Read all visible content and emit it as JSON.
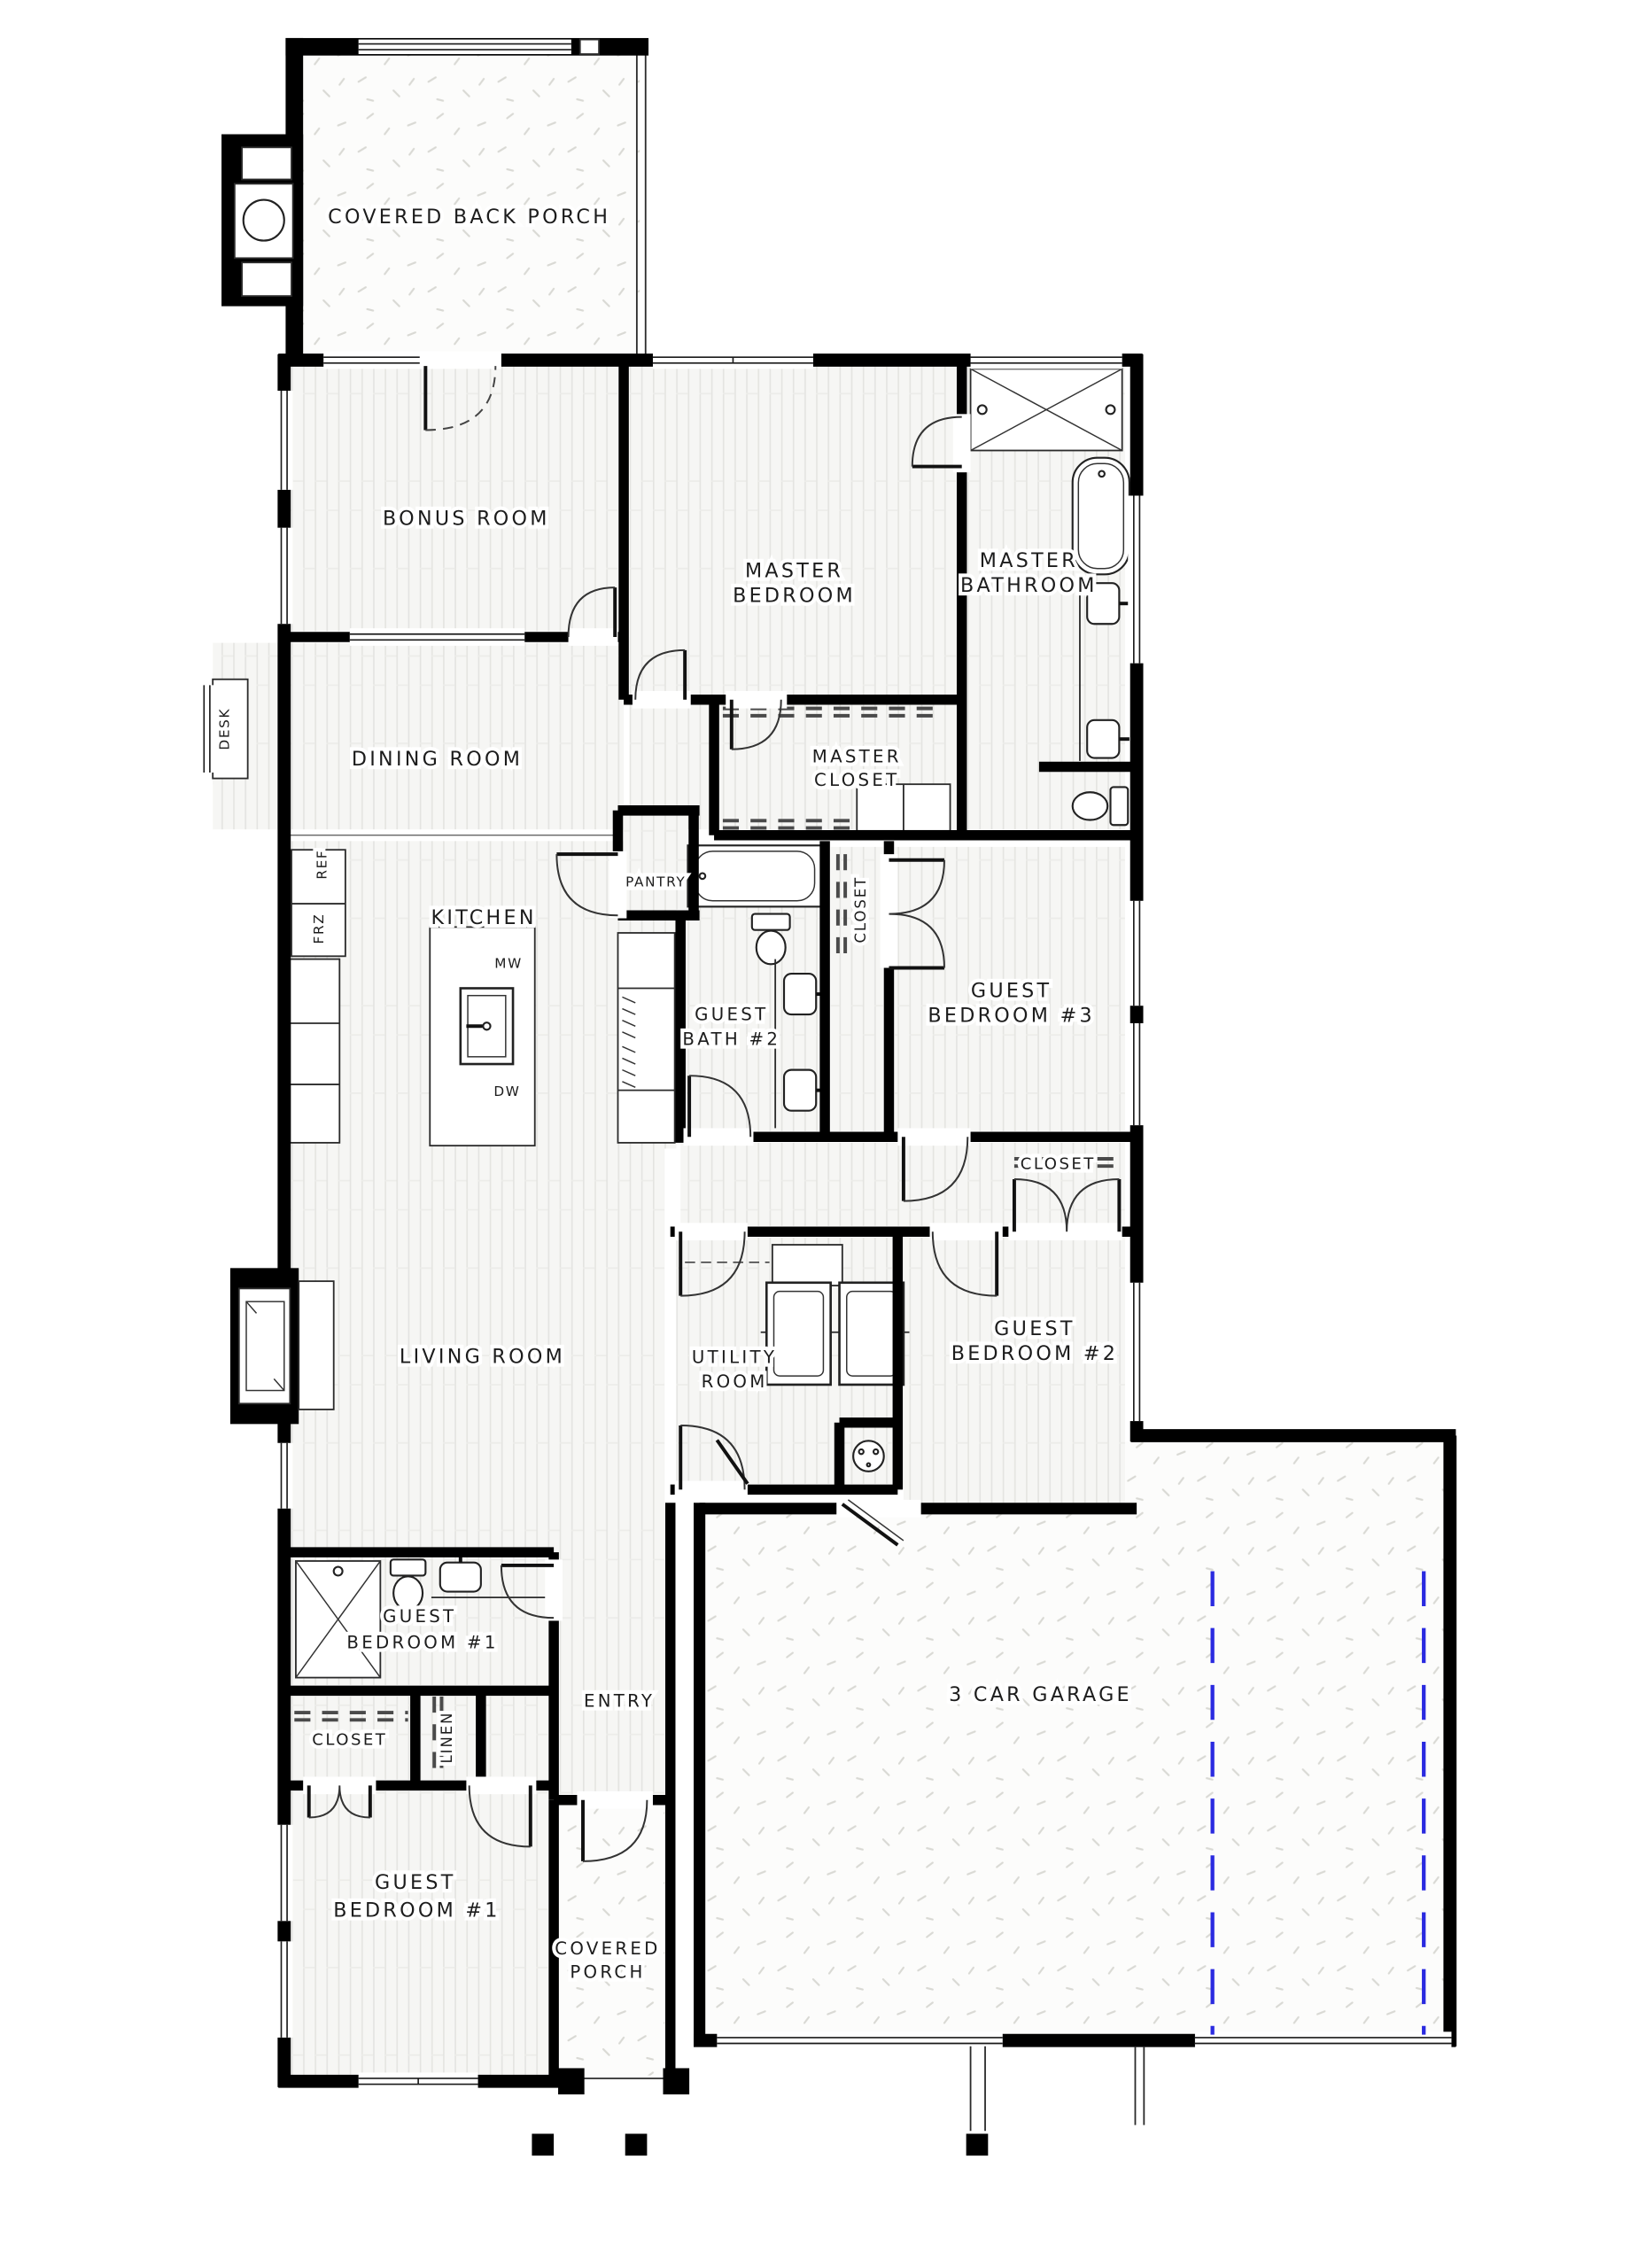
{
  "document": {
    "type": "residential-floor-plan"
  },
  "rooms": {
    "covered_back_porch": "COVERED BACK PORCH",
    "bonus_room": "BONUS ROOM",
    "master_bedroom": {
      "l1": "MASTER",
      "l2": "BEDROOM"
    },
    "master_bathroom": {
      "l1": "MASTER",
      "l2": "BATHROOM"
    },
    "dining_room": "DINING ROOM",
    "master_closet": {
      "l1": "MASTER",
      "l2": "CLOSET"
    },
    "kitchen": "KITCHEN",
    "pantry": "PANTRY",
    "guest_bath_2": {
      "l1": "GUEST",
      "l2": "BATH #2"
    },
    "guest_bedroom_3": {
      "l1": "GUEST",
      "l2": "BEDROOM #3"
    },
    "closet_hall": "CLOSET",
    "closet_bed3": "CLOSET",
    "living_room": "LIVING ROOM",
    "utility_room": {
      "l1": "UTILITY",
      "l2": "ROOM"
    },
    "guest_bedroom_2": {
      "l1": "GUEST",
      "l2": "BEDROOM #2"
    },
    "guest_suite_1": {
      "l1": "GUEST",
      "l2": "BEDROOM #1"
    },
    "entry": "ENTRY",
    "closet_front": "CLOSET",
    "linen": "LINEN",
    "guest_bedroom_1": {
      "l1": "GUEST",
      "l2": "BEDROOM #1"
    },
    "covered_porch": {
      "l1": "COVERED",
      "l2": "PORCH"
    },
    "garage": "3 CAR GARAGE"
  },
  "fixtures": {
    "desk": "DESK",
    "ref": "REF",
    "frz": "FRZ",
    "mw": "MW",
    "dw": "DW"
  },
  "colors": {
    "wall": "#000000",
    "text": "#1c1c1c",
    "floor": "#f6f6f4",
    "plank": "#e4e4e1",
    "joint": "#ecece9",
    "concrete": "#fcfcfb",
    "speckle": "#d9d9d4",
    "marker": "#2a2ae0"
  }
}
